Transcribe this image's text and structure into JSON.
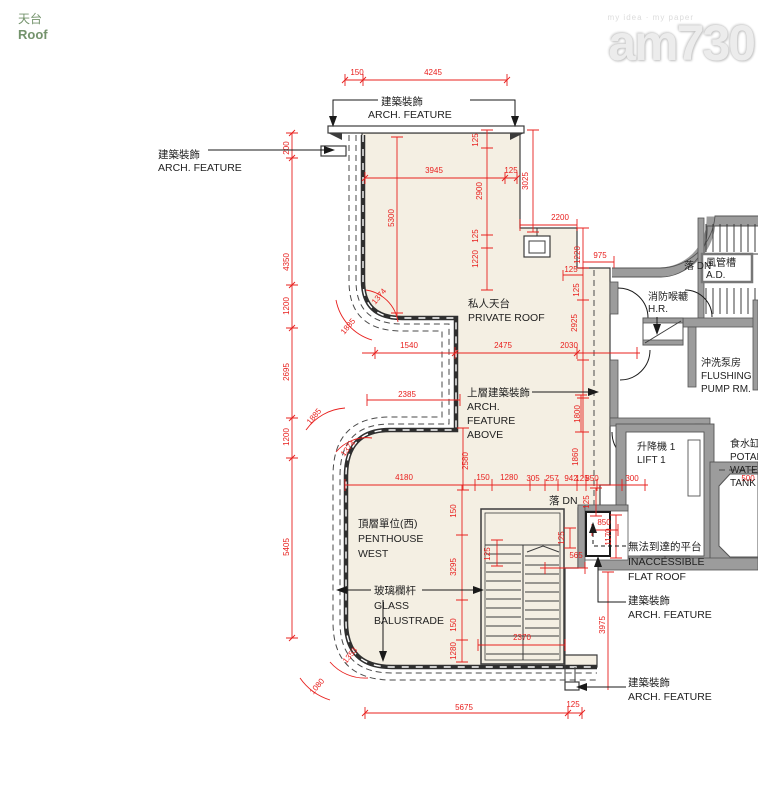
{
  "page": {
    "title_zh": "天台",
    "title_en": "Roof"
  },
  "watermark": {
    "slogan": "my idea · my paper",
    "brand": "am730"
  },
  "colors": {
    "accent_red": "#e8201e",
    "title_green": "#74936c",
    "roof_cream": "#f4efe3",
    "wall_gray": "#9c9c9c",
    "line_dark": "#3c3c3c",
    "watermark_gray": "#ececec"
  },
  "labels": {
    "arch_feature_top": {
      "zh": "建築裝飾",
      "en": "ARCH. FEATURE"
    },
    "arch_feature_left": {
      "zh": "建築裝飾",
      "en": "ARCH. FEATURE"
    },
    "private_roof": {
      "zh": "私人天台",
      "en": "PRIVATE ROOF"
    },
    "arch_feature_above": {
      "zh": "上層建築裝飾",
      "en1": "ARCH.",
      "en2": "FEATURE",
      "en3": "ABOVE"
    },
    "penthouse_west": {
      "zh": "頂層單位(西)",
      "en1": "PENTHOUSE",
      "en2": "WEST"
    },
    "glass_balustrade": {
      "zh": "玻璃欄杆",
      "en1": "GLASS",
      "en2": "BALUSTRADE"
    },
    "down_dn_core": {
      "text": "落 DN"
    },
    "air_duct": {
      "zh": "風管槽",
      "en": "A.D."
    },
    "hose_reel": {
      "zh": "消防喉轆",
      "en": "H.R."
    },
    "flushing_pump": {
      "zh": "沖洗泵房",
      "en1": "FLUSHING",
      "en2": "PUMP RM."
    },
    "lift": {
      "zh": "升降機 1",
      "en": "LIFT 1"
    },
    "water_tank": {
      "zh": "食水缸",
      "en1": "POTABLE",
      "en2": "WATER",
      "en3": "TANK"
    },
    "down_dn_penthouse": {
      "text": "落 DN"
    },
    "inaccessible": {
      "zh": "無法到達的平台",
      "en1": "INACCESSIBLE",
      "en2": "FLAT ROOF"
    },
    "arch_feature_mid": {
      "zh": "建築裝飾",
      "en": "ARCH. FEATURE"
    },
    "arch_feature_bottom": {
      "zh": "建築裝飾",
      "en": "ARCH. FEATURE"
    }
  },
  "dimensions": [
    {
      "t": "150",
      "x": 357,
      "y": 75,
      "r": 0
    },
    {
      "t": "4245",
      "x": 433,
      "y": 75,
      "r": 0
    },
    {
      "t": "200",
      "x": 289,
      "y": 148,
      "r": -90
    },
    {
      "t": "4350",
      "x": 289,
      "y": 262,
      "r": -90
    },
    {
      "t": "1200",
      "x": 289,
      "y": 306,
      "r": -90
    },
    {
      "t": "2695",
      "x": 289,
      "y": 372,
      "r": -90
    },
    {
      "t": "1200",
      "x": 289,
      "y": 437,
      "r": -90
    },
    {
      "t": "5405",
      "x": 289,
      "y": 547,
      "r": -90
    },
    {
      "t": "125",
      "x": 478,
      "y": 140,
      "r": -90
    },
    {
      "t": "3945",
      "x": 434,
      "y": 173,
      "r": 0
    },
    {
      "t": "125",
      "x": 511,
      "y": 173,
      "r": 0
    },
    {
      "t": "2900",
      "x": 482,
      "y": 191,
      "r": -90
    },
    {
      "t": "3025",
      "x": 528,
      "y": 181,
      "r": -90
    },
    {
      "t": "5300",
      "x": 394,
      "y": 218,
      "r": -90
    },
    {
      "t": "2200",
      "x": 560,
      "y": 220,
      "r": 0
    },
    {
      "t": "125",
      "x": 478,
      "y": 236,
      "r": -90
    },
    {
      "t": "1220",
      "x": 478,
      "y": 259,
      "r": -90
    },
    {
      "t": "1220",
      "x": 580,
      "y": 255,
      "r": -90
    },
    {
      "t": "975",
      "x": 600,
      "y": 258,
      "r": 0
    },
    {
      "t": "125",
      "x": 571,
      "y": 272,
      "r": 0
    },
    {
      "t": "125",
      "x": 579,
      "y": 290,
      "r": -90
    },
    {
      "t": "2925",
      "x": 577,
      "y": 323,
      "r": -90
    },
    {
      "t": "2030",
      "x": 569,
      "y": 348,
      "r": 0
    },
    {
      "t": "1374",
      "x": 381,
      "y": 298,
      "r": -50
    },
    {
      "t": "1885",
      "x": 350,
      "y": 328,
      "r": -50
    },
    {
      "t": "1885",
      "x": 316,
      "y": 418,
      "r": -50
    },
    {
      "t": "1374",
      "x": 350,
      "y": 450,
      "r": -50
    },
    {
      "t": "1353",
      "x": 352,
      "y": 657,
      "r": -50
    },
    {
      "t": "1080",
      "x": 319,
      "y": 688,
      "r": -50
    },
    {
      "t": "1540",
      "x": 409,
      "y": 348,
      "r": 0
    },
    {
      "t": "2475",
      "x": 503,
      "y": 348,
      "r": 0
    },
    {
      "t": "2385",
      "x": 407,
      "y": 397,
      "r": 0
    },
    {
      "t": "2580",
      "x": 468,
      "y": 461,
      "r": -90
    },
    {
      "t": "1800",
      "x": 580,
      "y": 414,
      "r": -90
    },
    {
      "t": "1860",
      "x": 578,
      "y": 457,
      "r": -90
    },
    {
      "t": "4180",
      "x": 404,
      "y": 480,
      "r": 0
    },
    {
      "t": "150",
      "x": 483,
      "y": 480,
      "r": 0
    },
    {
      "t": "1280",
      "x": 509,
      "y": 480,
      "r": 0
    },
    {
      "t": "305",
      "x": 533,
      "y": 481,
      "r": 0
    },
    {
      "t": "257",
      "x": 552,
      "y": 481,
      "r": 0
    },
    {
      "t": "942",
      "x": 571,
      "y": 481,
      "r": 0
    },
    {
      "t": "125",
      "x": 582,
      "y": 481,
      "r": 0
    },
    {
      "t": "850",
      "x": 592,
      "y": 481,
      "r": 0
    },
    {
      "t": "300",
      "x": 632,
      "y": 481,
      "r": 0
    },
    {
      "t": "500",
      "x": 748,
      "y": 481,
      "r": 0
    },
    {
      "t": "150",
      "x": 456,
      "y": 511,
      "r": -90
    },
    {
      "t": "3295",
      "x": 456,
      "y": 567,
      "r": -90
    },
    {
      "t": "150",
      "x": 456,
      "y": 625,
      "r": -90
    },
    {
      "t": "1280",
      "x": 456,
      "y": 651,
      "r": -90
    },
    {
      "t": "125",
      "x": 490,
      "y": 554,
      "r": -90
    },
    {
      "t": "125",
      "x": 564,
      "y": 538,
      "r": -90
    },
    {
      "t": "565",
      "x": 576,
      "y": 558,
      "r": 0
    },
    {
      "t": "2370",
      "x": 522,
      "y": 640,
      "r": 0
    },
    {
      "t": "125",
      "x": 589,
      "y": 502,
      "r": -90
    },
    {
      "t": "850",
      "x": 604,
      "y": 525,
      "r": 0
    },
    {
      "t": "1170",
      "x": 611,
      "y": 537,
      "r": -90
    },
    {
      "t": "5675",
      "x": 464,
      "y": 710,
      "r": 0
    },
    {
      "t": "125",
      "x": 573,
      "y": 707,
      "r": 0
    },
    {
      "t": "3975",
      "x": 605,
      "y": 625,
      "r": -90
    }
  ]
}
